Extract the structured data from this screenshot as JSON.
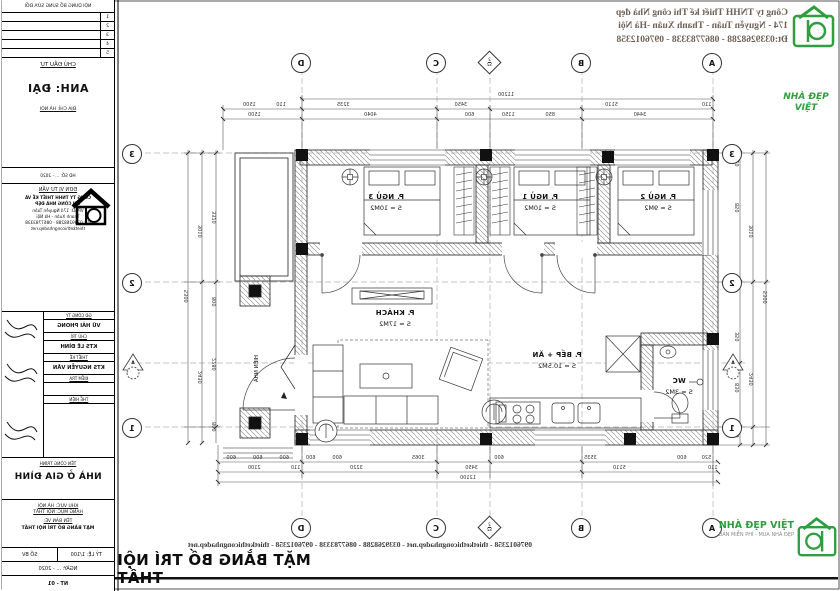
{
  "sheet": {
    "background": "#ffffff",
    "line_color": "#222222",
    "accent_green": "#2f9e3f"
  },
  "header": {
    "company_line1": "Công ty TNHH Thiết kế Thi công Nhà đẹp",
    "company_line2": "174 - Nguyễn Tuân - Thanh Xuân -Hà Nội",
    "company_line3": "Đt:0339268288 - 0867783338 - 0976012358"
  },
  "footer": {
    "contacts": "0976012358 - thietkethicongnhadep.net - 0339268288 - 0867783338 - 0976012358 - thietkethicongnhadep.net",
    "sheet_title": "MẶT BẰNG BỐ TRÍ NỘI THẤT"
  },
  "brand": {
    "watermark_line1": "NHÀ ĐẸP",
    "watermark_line2": "VIỆT",
    "bottom_name": "NHÀ ĐẸP VIỆT",
    "bottom_caption": "BẢN MIỄN PHÍ - MUA NHÀ ĐẸP"
  },
  "title_block": {
    "rev_header": "NỘI DUNG BỔ SUNG SỬA ĐỔI",
    "rev_rows": [
      "1",
      "2",
      "3",
      "4",
      "5"
    ],
    "investor_label": "CHỦ ĐẦU TƯ",
    "investor_name": "ANH: ĐẠI",
    "investor_address": "ĐỊA CHỈ: HÀ NỘI",
    "contract_line": "HĐ SỐ: ... - 2020",
    "consultant_label": "ĐƠN VỊ TƯ VẤN",
    "consultant_name1": "CÔNG TY TNHH THIẾT KẾ VÀ",
    "consultant_name2": "THI CÔNG NHÀ ĐẸP",
    "consultant_addr1": "VPGD: 174 Nguyễn Tuân",
    "consultant_addr2": "Thanh Xuân - Hà Nội",
    "consultant_addr3": "ĐT: 0339268288 - 0867783338",
    "consultant_addr4": "thietkethicongnhadep.net",
    "signatures": [
      {
        "role": "GĐ CÔNG TY",
        "name": "VŨ HẢI PHONG"
      },
      {
        "role": "CHỦ TRÌ",
        "name": "KTS LÊ ĐÌNH"
      },
      {
        "role": "THIẾT KẾ",
        "name": "KTS NGUYỄN VĂN"
      },
      {
        "role": "KIỂM TRA",
        "name": ""
      },
      {
        "role": "THỂ HIỆN",
        "name": ""
      }
    ],
    "project_label": "TÊN CÔNG TRÌNH",
    "project_name": "NHÀ Ở GIA ĐÌNH",
    "area_line1": "KHU VỰC: HÀ NỘI",
    "area_line2": "HẠNG MỤC: NỘI THẤT",
    "drawing_label": "TÊN BẢN VẼ:",
    "drawing_name": "MẶT BẰNG BỐ TRÍ NỘI THẤT",
    "scale_label": "TỶ LỆ: 1/100",
    "sheet_label": "SỐ BV",
    "date_line": "NGÀY: ... - 2020",
    "sheet_no": "NT - 01"
  },
  "plan": {
    "rooms": [
      {
        "name": "P. NGỦ 2",
        "area": "S = 9M2"
      },
      {
        "name": "P. NGỦ 1",
        "area": "S = 10M2"
      },
      {
        "name": "P. NGỦ 3",
        "area": "S = 10M2"
      },
      {
        "name": "P. KHÁCH",
        "area": "S = 17M2"
      },
      {
        "name": "P. BẾP + ĂN",
        "area": "S = 10.5M2"
      },
      {
        "name": "WC",
        "area": "S = 3M2"
      }
    ],
    "veranda_label": "HIÊN NHÀ",
    "grid": {
      "cols": [
        "A",
        "B",
        "C",
        "D"
      ],
      "rows": [
        "3",
        "2",
        "1"
      ],
      "col_marker": "2",
      "col_marker_sub": "S2",
      "row_marker": "A"
    },
    "dims": {
      "top_total": "11200",
      "top_row1": [
        "110",
        "5110",
        "3450",
        "3235",
        "110",
        "1500"
      ],
      "top_row2": [
        "3440",
        "850",
        "1150",
        "600",
        "4040",
        "1500"
      ],
      "bottom_fine": [
        "520",
        "600",
        "3535",
        "600",
        "3065",
        "600",
        "600",
        "600",
        "600",
        "600"
      ],
      "bottom_main": [
        "110",
        "5110",
        "3450",
        "3220",
        "110",
        "2100"
      ],
      "bottom_total": "12100",
      "left_inner": [
        "110",
        "850",
        "980",
        "350",
        "830",
        "110"
      ],
      "left_mid": [
        "3010",
        "2430"
      ],
      "left_total": "5300",
      "right_inner": [
        "3320",
        "800",
        "2280",
        "800"
      ],
      "right_mid": [
        "3010",
        "2430"
      ],
      "right_total": "5300"
    }
  }
}
